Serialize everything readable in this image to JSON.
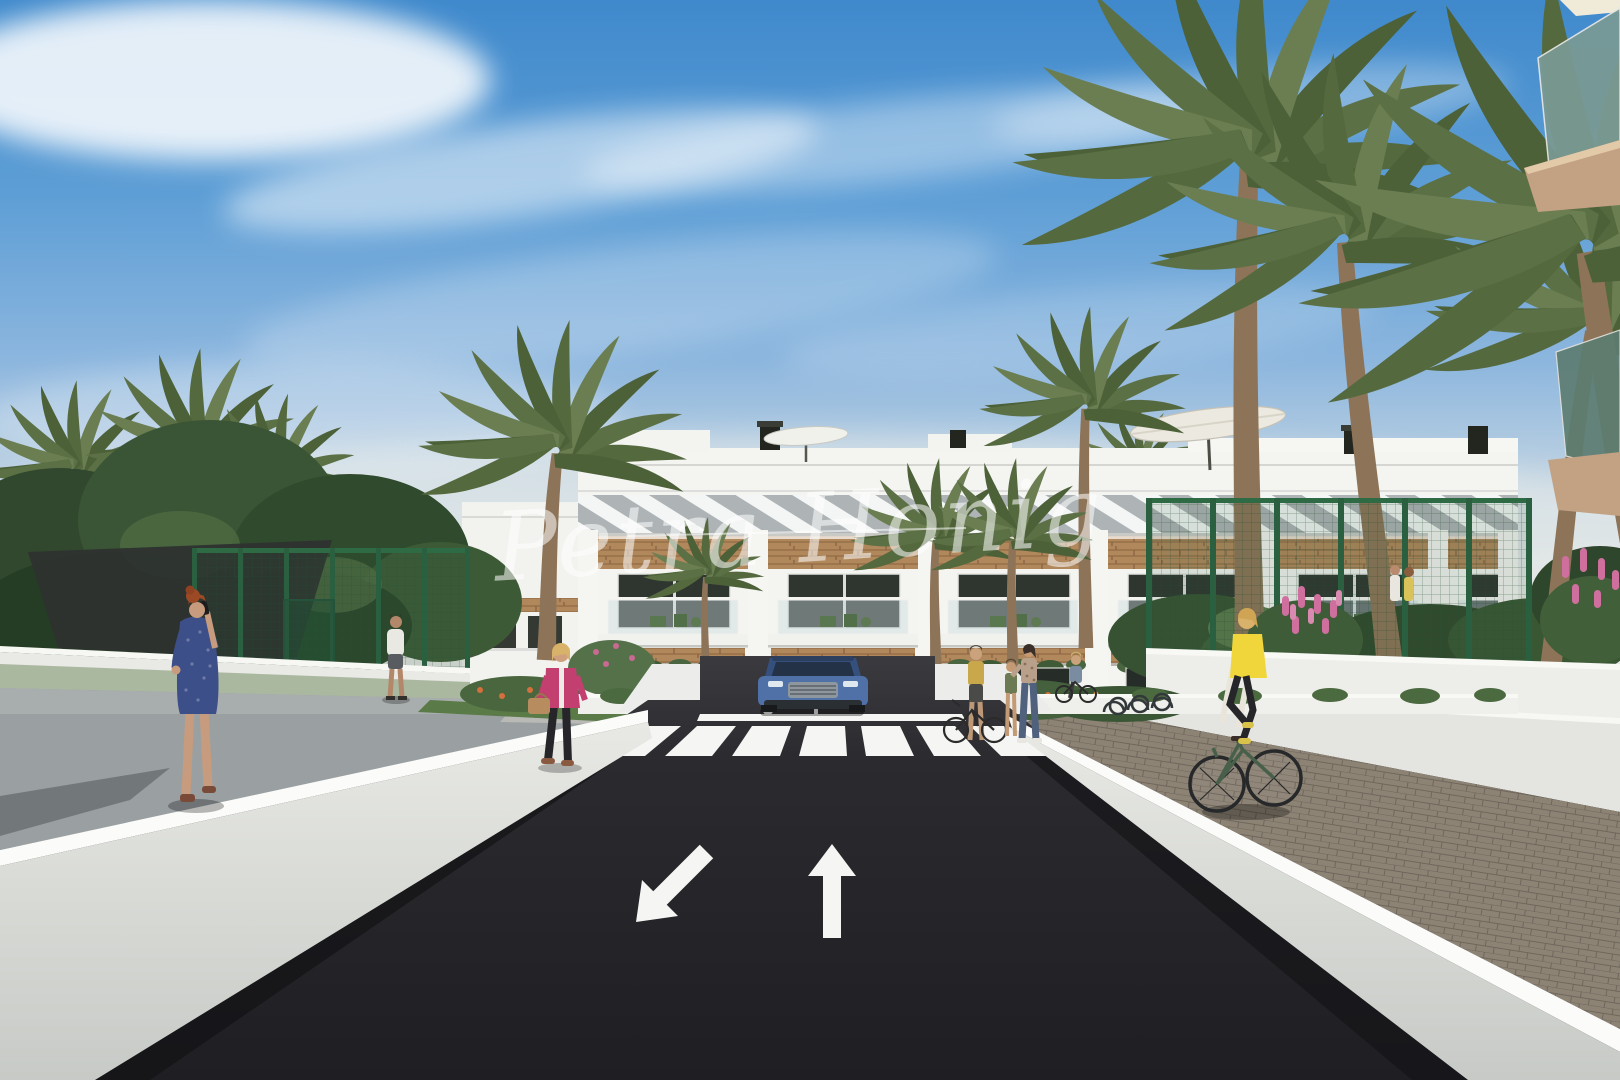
{
  "watermark": {
    "text": "Petra Honig",
    "style": "handwritten-script-overlay",
    "color": "#ffffff",
    "opacity": 0.55
  },
  "scene": {
    "type": "3d-architectural-rendering",
    "setting": "street view of a modern white apartment complex with palm trees, access road, crosswalk and pedestrians",
    "sky": {
      "top": "#3f89cc",
      "mid": "#8cb6de",
      "horizon_haze": "#e4e6e3",
      "clouds": "wispy white cirrus streaks"
    },
    "building": {
      "facade": "#f4f4f1",
      "pergola_slats": "#f4f6f5",
      "slat_shadow": "#aeb4b6",
      "wood_cladding": "#b1885c",
      "window_glass": "#2f352f",
      "floors_visible": 3,
      "roof_items": [
        "chimneys",
        "patio-umbrellas",
        "roof-terrace-walls"
      ]
    },
    "road": {
      "surface": "#26262a",
      "marking_color": "#f5f5f3",
      "crosswalk_stripes": 7,
      "lane_arrows": [
        "oncoming-down-left",
        "forward-up"
      ],
      "stop_line": true
    },
    "walls": {
      "retaining": "#e9eae6",
      "cap_highlight": "#fbfbf9"
    },
    "sidewalks": {
      "left_concrete": "#9aa0a2",
      "right_pavers": "#8d8375"
    },
    "vegetation": {
      "palm_fronds": "#5c7045",
      "palm_trunk": "#8d7458",
      "shrubs_dark": "#31472e",
      "flowers_pink": "#cf6f9e",
      "flowers_orange": "#d4703c",
      "grass": "#5f7d4b"
    },
    "fence_color": "#2e6b45",
    "shade_sail": "#2e3230",
    "car": {
      "type": "suv-front-view",
      "body": "#4f71a8",
      "grille": "#8e969e"
    },
    "people": [
      {
        "id": "woman-blue-dress-on-phone",
        "hair": "#9c4a26",
        "dress": "#3d4f88",
        "location": "left-sidewalk"
      },
      {
        "id": "man-white-shirt",
        "location": "left-garden-gate"
      },
      {
        "id": "woman-pink-jacket-handbag",
        "jacket": "#c23f70",
        "bag": "#b78c5f",
        "location": "center-left-walkway"
      },
      {
        "id": "woman-with-bicycle",
        "top": "#c9a84c",
        "location": "right-of-crosswalk"
      },
      {
        "id": "child",
        "top": "#6b7a52",
        "location": "right-of-crosswalk"
      },
      {
        "id": "woman-floral-top-jeans",
        "location": "right-of-crosswalk"
      },
      {
        "id": "woman-cyclist-small",
        "location": "bike-racks"
      },
      {
        "id": "cyclist-yellow-vest",
        "vest": "#f0d63a",
        "bike": "#48604a",
        "location": "right-paver-sidewalk"
      },
      {
        "id": "balcony-couple",
        "location": "first-floor-balcony-right-block"
      }
    ]
  }
}
